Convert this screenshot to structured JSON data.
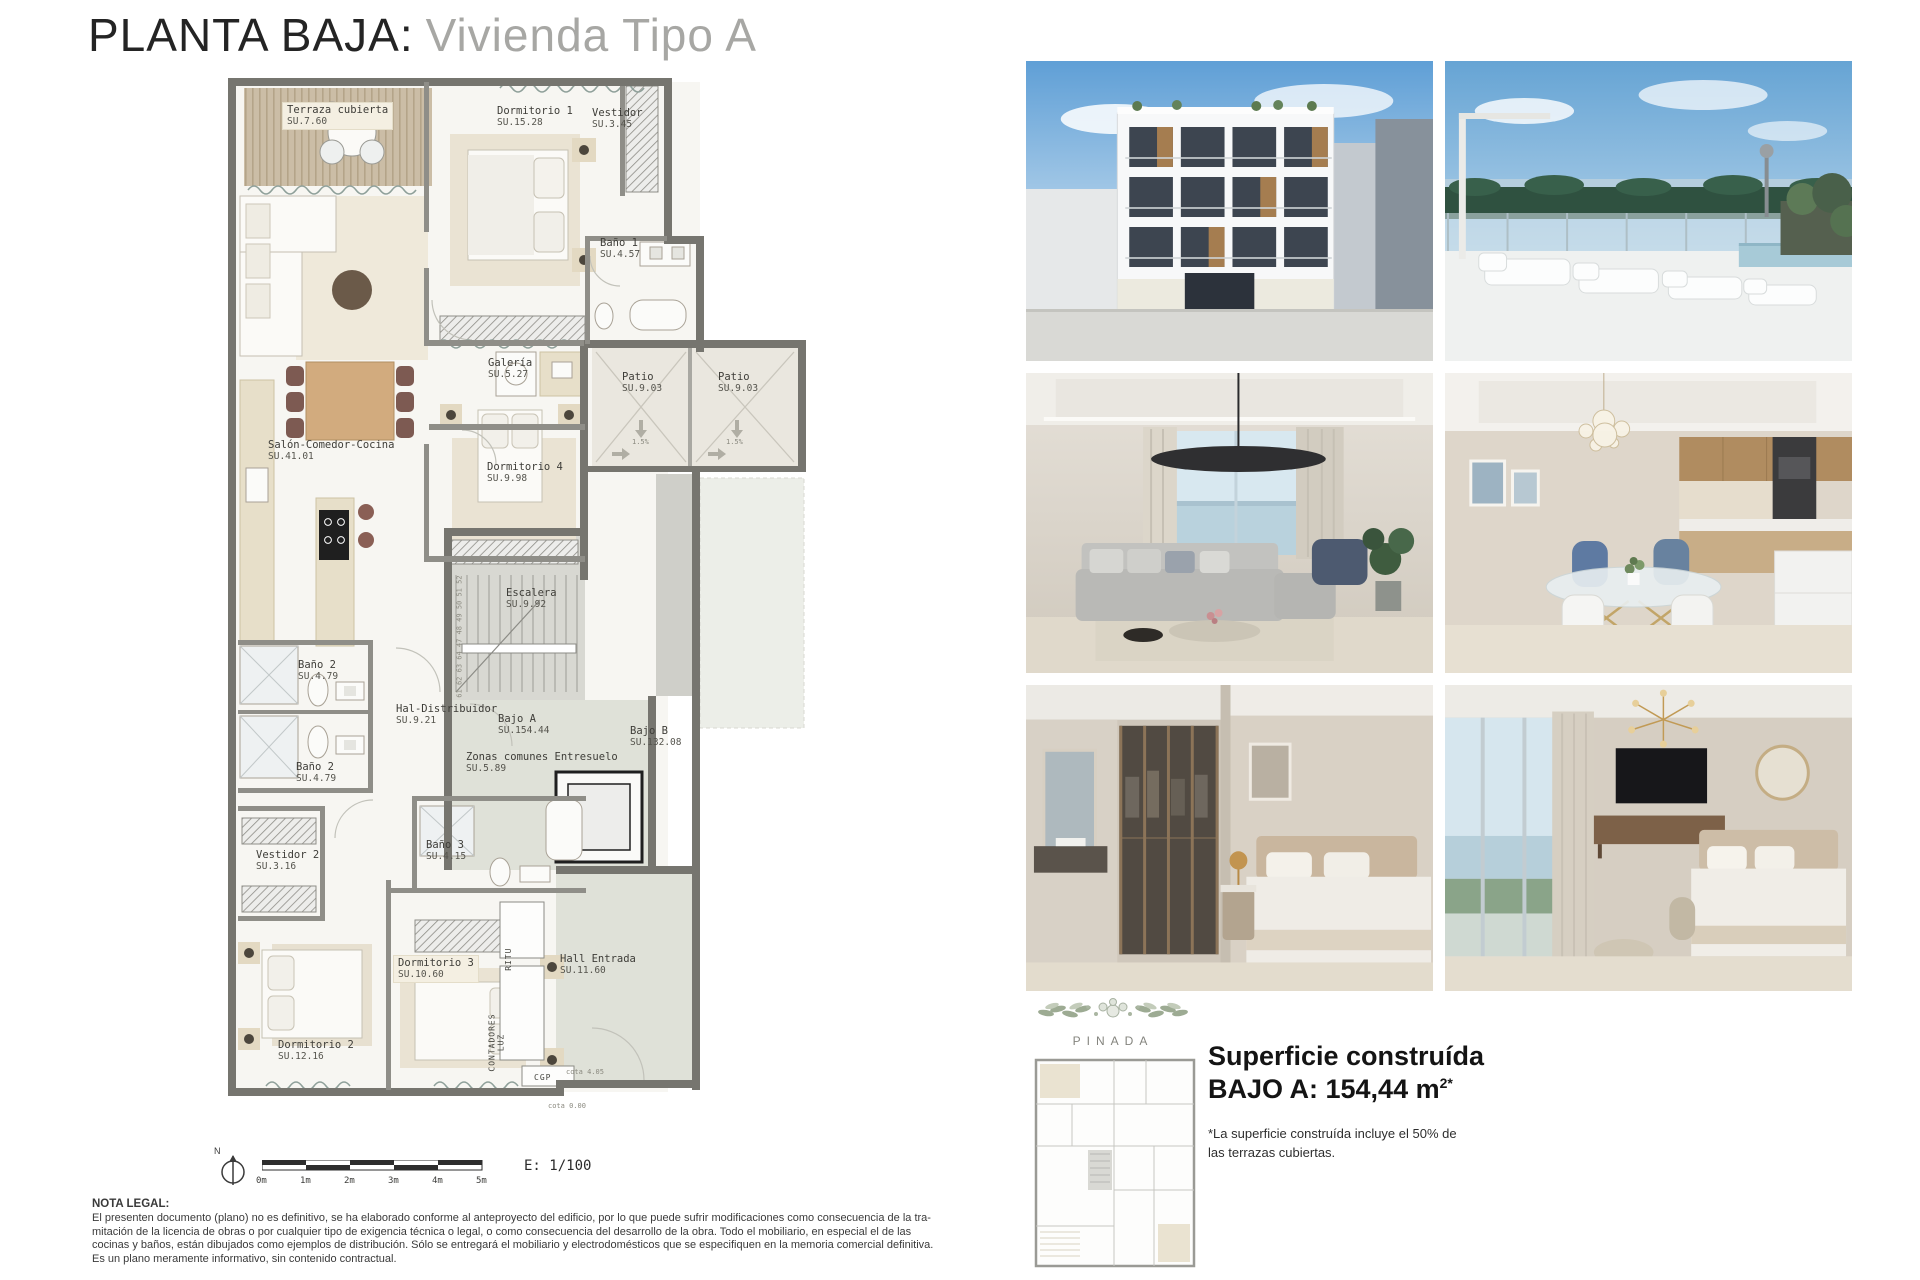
{
  "title": {
    "main": "PLANTA BAJA:",
    "sub": "Vivienda Tipo A"
  },
  "plan": {
    "rooms": [
      {
        "name": "Terraza cubierta",
        "area": "SU.7.60",
        "x": 283,
        "y": 103,
        "box": true
      },
      {
        "name": "Dormitorio 1",
        "area": "SU.15.28",
        "x": 497,
        "y": 106
      },
      {
        "name": "Vestidor",
        "area": "SU.3.45",
        "x": 592,
        "y": 108
      },
      {
        "name": "Baño 1",
        "area": "SU.4.57",
        "x": 600,
        "y": 238
      },
      {
        "name": "Galería",
        "area": "SU.5.27",
        "x": 488,
        "y": 358
      },
      {
        "name": "Salón-Comedor-Cocina",
        "area": "SU.41.01",
        "x": 268,
        "y": 440
      },
      {
        "name": "Dormitorio 4",
        "area": "SU.9.98",
        "x": 487,
        "y": 462
      },
      {
        "name": "Patio",
        "area": "SU.9.03",
        "x": 622,
        "y": 372
      },
      {
        "name": "Patio",
        "area": "SU.9.03",
        "x": 718,
        "y": 372
      },
      {
        "name": "Escalera",
        "area": "SU.9.92",
        "x": 506,
        "y": 588
      },
      {
        "name": "Baño 2",
        "area": "SU.4.79",
        "x": 298,
        "y": 660
      },
      {
        "name": "Baño 2",
        "area": "SU.4.79",
        "x": 296,
        "y": 762
      },
      {
        "name": "Hal-Distribuidor",
        "area": "SU.9.21",
        "x": 396,
        "y": 704
      },
      {
        "name": "Bajo A",
        "area": "SU.154.44",
        "x": 498,
        "y": 714
      },
      {
        "name": "Zonas comunes Entresuelo",
        "area": "SU.5.89",
        "x": 466,
        "y": 752
      },
      {
        "name": "Bajo B",
        "area": "SU.132.08",
        "x": 630,
        "y": 726
      },
      {
        "name": "Vestidor 2",
        "area": "SU.3.16",
        "x": 256,
        "y": 850
      },
      {
        "name": "Baño 3",
        "area": "SU.4.15",
        "x": 426,
        "y": 840
      },
      {
        "name": "Dormitorio 3",
        "area": "SU.10.60",
        "x": 394,
        "y": 956,
        "box": true
      },
      {
        "name": "Dormitorio 2",
        "area": "SU.12.16",
        "x": 278,
        "y": 1040
      },
      {
        "name": "Hall Entrada",
        "area": "SU.11.60",
        "x": 560,
        "y": 954
      }
    ],
    "small_labels": [
      {
        "text": "RITU",
        "x": 514,
        "y": 962,
        "cls": "vert tech"
      },
      {
        "text": "CONTADORES\nLUZ",
        "x": 506,
        "y": 1054,
        "cls": "vert tech"
      },
      {
        "text": "CGP",
        "x": 534,
        "y": 1073,
        "cls": "tech"
      },
      {
        "text": "cota 4.05",
        "x": 566,
        "y": 1068,
        "cls": "micro"
      },
      {
        "text": "cota 0.00",
        "x": 548,
        "y": 1102,
        "cls": "micro"
      },
      {
        "text": "61 62 63 64 47 48 49 50 51 52",
        "x": 464,
        "y": 690,
        "cls": "vert micro"
      },
      {
        "text": "1.5%",
        "x": 632,
        "y": 438,
        "cls": "micro"
      },
      {
        "text": "1.5%",
        "x": 726,
        "y": 438,
        "cls": "micro"
      }
    ],
    "scale": {
      "north": "N",
      "ticks": [
        "0m",
        "1m",
        "2m",
        "3m",
        "4m",
        "5m"
      ],
      "ratio": "E: 1/100"
    }
  },
  "photos": [
    "building-exterior-render",
    "rooftop-terrace-render",
    "living-room-render",
    "dining-room-kitchen-render",
    "bedroom-dressing-bathroom-render",
    "bedroom-tv-render"
  ],
  "brand": {
    "name": "PINADA"
  },
  "summary": {
    "line1": "Superficie construída",
    "line2": "BAJO A: 154,44 m",
    "sup": "2*",
    "note": "*La superficie construída incluye el 50% de\nlas terrazas cubiertas."
  },
  "legal": {
    "heading": "NOTA LEGAL:",
    "lines": [
      "El presenten documento (plano) no es definitivo, se ha elaborado conforme al anteproyecto del edificio, por lo que puede sufrir modificaciones como consecuencia de la tra-",
      "mitación de la licencia de obras o por cualquier tipo de exigencia técnica o legal, o como consecuencia del desarrollo de la obra. Todo el mobiliario, en especial el de las",
      "cocinas y baños, están dibujados como ejemplos de distribución. Sólo se entregará el mobiliario y electrodomésticos que se especifiquen en la memoria comercial definitiva.",
      "Es un plano meramente informativo, sin contenido contractual."
    ]
  }
}
